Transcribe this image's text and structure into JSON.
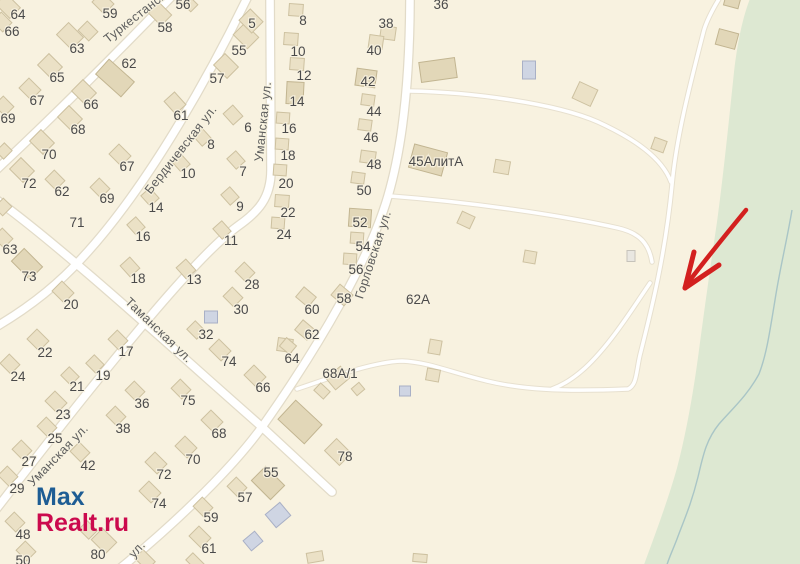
{
  "map": {
    "background_color": "#f8f2e0",
    "greenery_color": "#dde8d2",
    "stream_color": "#a9c5c6",
    "road_fill_color": "#ffffff",
    "road_casing_color": "#e2dbc8",
    "arrow_color": "#d3201f",
    "house_number_color": "#4a4a4a",
    "street_name_color": "#5e5e5e",
    "street_labels": [
      {
        "text": "Туркестанская",
        "x": 143,
        "y": 16,
        "rot": -38
      },
      {
        "text": "Бердичевская ул.",
        "x": 184,
        "y": 152,
        "rot": -52
      },
      {
        "text": "Уманская ул.",
        "x": 267,
        "y": 122,
        "rot": -84
      },
      {
        "text": "Таманская ул.",
        "x": 156,
        "y": 333,
        "rot": 44
      },
      {
        "text": "Горловская ул.",
        "x": 377,
        "y": 256,
        "rot": -72
      },
      {
        "text": "Уманская ул.",
        "x": 61,
        "y": 458,
        "rot": -46
      },
      {
        "text": "ул.",
        "x": 140,
        "y": 552,
        "rot": -48
      }
    ],
    "house_numbers": [
      {
        "t": "64",
        "x": 18,
        "y": 14
      },
      {
        "t": "66",
        "x": 12,
        "y": 31
      },
      {
        "t": "59",
        "x": 110,
        "y": 13
      },
      {
        "t": "56",
        "x": 183,
        "y": 4
      },
      {
        "t": "58",
        "x": 165,
        "y": 27
      },
      {
        "t": "5",
        "x": 252,
        "y": 23
      },
      {
        "t": "63",
        "x": 77,
        "y": 48
      },
      {
        "t": "62",
        "x": 129,
        "y": 63
      },
      {
        "t": "55",
        "x": 239,
        "y": 50
      },
      {
        "t": "57",
        "x": 217,
        "y": 78
      },
      {
        "t": "65",
        "x": 57,
        "y": 77
      },
      {
        "t": "67",
        "x": 37,
        "y": 100
      },
      {
        "t": "66",
        "x": 91,
        "y": 104
      },
      {
        "t": "61",
        "x": 181,
        "y": 115
      },
      {
        "t": "69",
        "x": 8,
        "y": 118
      },
      {
        "t": "68",
        "x": 78,
        "y": 129
      },
      {
        "t": "6",
        "x": 248,
        "y": 127
      },
      {
        "t": "8",
        "x": 211,
        "y": 144
      },
      {
        "t": "70",
        "x": 49,
        "y": 154
      },
      {
        "t": "67",
        "x": 127,
        "y": 166
      },
      {
        "t": "10",
        "x": 188,
        "y": 173
      },
      {
        "t": "7",
        "x": 243,
        "y": 171
      },
      {
        "t": "72",
        "x": 29,
        "y": 183
      },
      {
        "t": "62",
        "x": 62,
        "y": 191
      },
      {
        "t": "69",
        "x": 107,
        "y": 198
      },
      {
        "t": "14",
        "x": 156,
        "y": 207
      },
      {
        "t": "9",
        "x": 240,
        "y": 206
      },
      {
        "t": "71",
        "x": 77,
        "y": 222
      },
      {
        "t": "16",
        "x": 143,
        "y": 236
      },
      {
        "t": "11",
        "x": 231,
        "y": 240
      },
      {
        "t": "63",
        "x": 10,
        "y": 249
      },
      {
        "t": "73",
        "x": 29,
        "y": 276
      },
      {
        "t": "18",
        "x": 138,
        "y": 278
      },
      {
        "t": "13",
        "x": 194,
        "y": 279
      },
      {
        "t": "28",
        "x": 252,
        "y": 284
      },
      {
        "t": "20",
        "x": 71,
        "y": 304
      },
      {
        "t": "30",
        "x": 241,
        "y": 309
      },
      {
        "t": "32",
        "x": 206,
        "y": 334
      },
      {
        "t": "22",
        "x": 45,
        "y": 352
      },
      {
        "t": "17",
        "x": 126,
        "y": 351
      },
      {
        "t": "74",
        "x": 229,
        "y": 361
      },
      {
        "t": "24",
        "x": 18,
        "y": 376
      },
      {
        "t": "19",
        "x": 103,
        "y": 375
      },
      {
        "t": "21",
        "x": 77,
        "y": 386
      },
      {
        "t": "66",
        "x": 263,
        "y": 387
      },
      {
        "t": "36",
        "x": 142,
        "y": 403
      },
      {
        "t": "23",
        "x": 63,
        "y": 414
      },
      {
        "t": "75",
        "x": 188,
        "y": 400
      },
      {
        "t": "38",
        "x": 123,
        "y": 428
      },
      {
        "t": "68",
        "x": 219,
        "y": 433
      },
      {
        "t": "25",
        "x": 55,
        "y": 438
      },
      {
        "t": "42",
        "x": 88,
        "y": 465
      },
      {
        "t": "70",
        "x": 193,
        "y": 459
      },
      {
        "t": "27",
        "x": 29,
        "y": 461
      },
      {
        "t": "72",
        "x": 164,
        "y": 474
      },
      {
        "t": "55",
        "x": 271,
        "y": 472
      },
      {
        "t": "29",
        "x": 17,
        "y": 488
      },
      {
        "t": "74",
        "x": 159,
        "y": 503
      },
      {
        "t": "57",
        "x": 245,
        "y": 497
      },
      {
        "t": "59",
        "x": 211,
        "y": 517
      },
      {
        "t": "48",
        "x": 23,
        "y": 534
      },
      {
        "t": "61",
        "x": 209,
        "y": 548
      },
      {
        "t": "50",
        "x": 23,
        "y": 560
      },
      {
        "t": "80",
        "x": 98,
        "y": 554
      },
      {
        "t": "78",
        "x": 345,
        "y": 456
      },
      {
        "t": "8",
        "x": 303,
        "y": 20
      },
      {
        "t": "10",
        "x": 298,
        "y": 51
      },
      {
        "t": "12",
        "x": 304,
        "y": 75
      },
      {
        "t": "14",
        "x": 297,
        "y": 101
      },
      {
        "t": "16",
        "x": 289,
        "y": 128
      },
      {
        "t": "18",
        "x": 288,
        "y": 155
      },
      {
        "t": "20",
        "x": 286,
        "y": 183
      },
      {
        "t": "22",
        "x": 288,
        "y": 212
      },
      {
        "t": "24",
        "x": 284,
        "y": 234
      },
      {
        "t": "36",
        "x": 441,
        "y": 4
      },
      {
        "t": "38",
        "x": 386,
        "y": 23
      },
      {
        "t": "40",
        "x": 374,
        "y": 50
      },
      {
        "t": "42",
        "x": 368,
        "y": 81
      },
      {
        "t": "44",
        "x": 374,
        "y": 111
      },
      {
        "t": "46",
        "x": 371,
        "y": 137
      },
      {
        "t": "48",
        "x": 374,
        "y": 164
      },
      {
        "t": "50",
        "x": 364,
        "y": 190
      },
      {
        "t": "52",
        "x": 360,
        "y": 222
      },
      {
        "t": "54",
        "x": 363,
        "y": 246
      },
      {
        "t": "56",
        "x": 356,
        "y": 269
      },
      {
        "t": "58",
        "x": 344,
        "y": 298
      },
      {
        "t": "60",
        "x": 312,
        "y": 309
      },
      {
        "t": "62",
        "x": 312,
        "y": 334
      },
      {
        "t": "64",
        "x": 292,
        "y": 358
      },
      {
        "t": "68А/1",
        "x": 340,
        "y": 373
      },
      {
        "t": "62А",
        "x": 418,
        "y": 299
      },
      {
        "t": "45АлитА",
        "x": 436,
        "y": 161
      }
    ],
    "buildings": [
      [
        8,
        6,
        20,
        15,
        45,
        0
      ],
      [
        2,
        22,
        15,
        13,
        45,
        0
      ],
      [
        103,
        3,
        17,
        14,
        45,
        0
      ],
      [
        189,
        3,
        15,
        10,
        45,
        0
      ],
      [
        160,
        14,
        18,
        15,
        45,
        0
      ],
      [
        70,
        36,
        21,
        17,
        45,
        0
      ],
      [
        88,
        31,
        15,
        13,
        45,
        0
      ],
      [
        246,
        36,
        20,
        16,
        45,
        0
      ],
      [
        251,
        21,
        18,
        16,
        45,
        0
      ],
      [
        226,
        66,
        19,
        16,
        45,
        0
      ],
      [
        115,
        78,
        34,
        20,
        42,
        1
      ],
      [
        50,
        66,
        19,
        16,
        45,
        0
      ],
      [
        30,
        89,
        17,
        14,
        45,
        0
      ],
      [
        84,
        92,
        19,
        16,
        45,
        0
      ],
      [
        4,
        106,
        15,
        13,
        45,
        0
      ],
      [
        70,
        118,
        19,
        16,
        45,
        0
      ],
      [
        42,
        142,
        19,
        16,
        45,
        0
      ],
      [
        4,
        151,
        11,
        12,
        45,
        0
      ],
      [
        22,
        170,
        19,
        16,
        45,
        0
      ],
      [
        120,
        155,
        17,
        14,
        45,
        0
      ],
      [
        55,
        180,
        15,
        13,
        45,
        0
      ],
      [
        100,
        188,
        15,
        13,
        45,
        0
      ],
      [
        175,
        103,
        17,
        14,
        48,
        0
      ],
      [
        233,
        115,
        15,
        13,
        48,
        0
      ],
      [
        236,
        160,
        14,
        12,
        48,
        0
      ],
      [
        230,
        196,
        14,
        12,
        48,
        0
      ],
      [
        222,
        230,
        14,
        12,
        48,
        0
      ],
      [
        202,
        137,
        14,
        12,
        48,
        0
      ],
      [
        181,
        163,
        14,
        12,
        48,
        0
      ],
      [
        150,
        197,
        14,
        12,
        48,
        0
      ],
      [
        136,
        226,
        14,
        12,
        48,
        0
      ],
      [
        130,
        267,
        15,
        13,
        48,
        0
      ],
      [
        186,
        269,
        15,
        13,
        48,
        0
      ],
      [
        3,
        238,
        15,
        13,
        45,
        0
      ],
      [
        27,
        264,
        26,
        18,
        45,
        1
      ],
      [
        3,
        207,
        12,
        13,
        45,
        0
      ],
      [
        63,
        292,
        17,
        14,
        45,
        0
      ],
      [
        38,
        340,
        17,
        14,
        45,
        0
      ],
      [
        10,
        364,
        15,
        13,
        45,
        0
      ],
      [
        118,
        340,
        15,
        13,
        45,
        0
      ],
      [
        95,
        364,
        14,
        12,
        45,
        0
      ],
      [
        70,
        376,
        14,
        12,
        45,
        0
      ],
      [
        245,
        272,
        15,
        13,
        45,
        0
      ],
      [
        233,
        297,
        15,
        13,
        45,
        0
      ],
      [
        211,
        317,
        13,
        12,
        0,
        2
      ],
      [
        196,
        330,
        14,
        12,
        45,
        0
      ],
      [
        220,
        350,
        17,
        14,
        45,
        0
      ],
      [
        285,
        345,
        15,
        13,
        8,
        0
      ],
      [
        255,
        376,
        17,
        14,
        45,
        0
      ],
      [
        56,
        402,
        17,
        14,
        45,
        0
      ],
      [
        47,
        427,
        15,
        13,
        45,
        0
      ],
      [
        22,
        450,
        15,
        13,
        45,
        0
      ],
      [
        8,
        476,
        15,
        13,
        45,
        0
      ],
      [
        135,
        391,
        15,
        13,
        45,
        0
      ],
      [
        116,
        416,
        15,
        13,
        45,
        0
      ],
      [
        80,
        452,
        15,
        13,
        45,
        0
      ],
      [
        181,
        389,
        15,
        13,
        45,
        0
      ],
      [
        212,
        421,
        17,
        14,
        45,
        0
      ],
      [
        186,
        447,
        17,
        14,
        45,
        0
      ],
      [
        156,
        463,
        17,
        14,
        45,
        0
      ],
      [
        268,
        483,
        27,
        20,
        45,
        1
      ],
      [
        150,
        492,
        17,
        14,
        45,
        0
      ],
      [
        237,
        487,
        15,
        13,
        45,
        0
      ],
      [
        203,
        507,
        15,
        13,
        45,
        0
      ],
      [
        15,
        522,
        15,
        13,
        45,
        0
      ],
      [
        200,
        537,
        17,
        14,
        45,
        0
      ],
      [
        26,
        551,
        15,
        13,
        45,
        0
      ],
      [
        104,
        541,
        20,
        16,
        45,
        0
      ],
      [
        88,
        530,
        14,
        12,
        45,
        0
      ],
      [
        338,
        452,
        21,
        17,
        45,
        0
      ],
      [
        300,
        422,
        36,
        26,
        43,
        1
      ],
      [
        322,
        391,
        13,
        10,
        43,
        0
      ],
      [
        145,
        560,
        17,
        12,
        45,
        0
      ],
      [
        195,
        562,
        16,
        10,
        45,
        0
      ],
      [
        296,
        10,
        14,
        12,
        4,
        0
      ],
      [
        291,
        39,
        14,
        12,
        4,
        0
      ],
      [
        297,
        64,
        14,
        12,
        4,
        0
      ],
      [
        295,
        93,
        17,
        22,
        3,
        1
      ],
      [
        283,
        118,
        13,
        11,
        4,
        0
      ],
      [
        282,
        144,
        13,
        11,
        4,
        0
      ],
      [
        280,
        170,
        13,
        11,
        4,
        0
      ],
      [
        282,
        201,
        14,
        12,
        4,
        0
      ],
      [
        278,
        223,
        13,
        11,
        4,
        0
      ],
      [
        388,
        33,
        15,
        13,
        8,
        0
      ],
      [
        376,
        42,
        14,
        13,
        8,
        0
      ],
      [
        366,
        78,
        20,
        17,
        8,
        1
      ],
      [
        368,
        100,
        13,
        11,
        8,
        0
      ],
      [
        365,
        125,
        13,
        11,
        8,
        0
      ],
      [
        368,
        157,
        15,
        12,
        8,
        0
      ],
      [
        358,
        178,
        13,
        11,
        8,
        0
      ],
      [
        360,
        218,
        22,
        18,
        4,
        1
      ],
      [
        357,
        238,
        13,
        11,
        4,
        0
      ],
      [
        350,
        259,
        13,
        11,
        4,
        0
      ],
      [
        342,
        295,
        17,
        14,
        40,
        0
      ],
      [
        306,
        297,
        16,
        13,
        40,
        0
      ],
      [
        305,
        330,
        16,
        13,
        40,
        0
      ],
      [
        288,
        346,
        13,
        11,
        40,
        0
      ],
      [
        338,
        378,
        19,
        15,
        -40,
        0
      ],
      [
        358,
        389,
        10,
        9,
        -40,
        0
      ],
      [
        405,
        391,
        11,
        10,
        0,
        2
      ],
      [
        438,
        70,
        36,
        20,
        -8,
        1
      ],
      [
        529,
        70,
        13,
        18,
        0,
        2
      ],
      [
        585,
        94,
        20,
        18,
        25,
        0
      ],
      [
        428,
        160,
        34,
        24,
        15,
        1
      ],
      [
        502,
        167,
        15,
        13,
        10,
        0
      ],
      [
        466,
        220,
        14,
        13,
        25,
        0
      ],
      [
        530,
        257,
        12,
        12,
        10,
        0
      ],
      [
        435,
        347,
        12,
        14,
        10,
        0
      ],
      [
        433,
        375,
        13,
        12,
        10,
        0
      ],
      [
        727,
        39,
        20,
        16,
        15,
        1
      ],
      [
        732,
        2,
        15,
        10,
        15,
        1
      ],
      [
        659,
        145,
        13,
        12,
        20,
        0
      ],
      [
        631,
        256,
        8,
        11,
        0,
        3
      ],
      [
        278,
        515,
        19,
        17,
        -40,
        2
      ],
      [
        253,
        541,
        15,
        13,
        -40,
        2
      ],
      [
        315,
        557,
        16,
        10,
        -10,
        0
      ],
      [
        420,
        558,
        14,
        8,
        5,
        0
      ]
    ]
  },
  "watermark": {
    "line1": "Max",
    "line2": "Realt.ru",
    "line1_color": "#1e5d94",
    "line2_color": "#cb0a4d"
  },
  "annotation": {
    "arrow_icon": "red-arrow",
    "arrow_color": "#d3201f"
  }
}
